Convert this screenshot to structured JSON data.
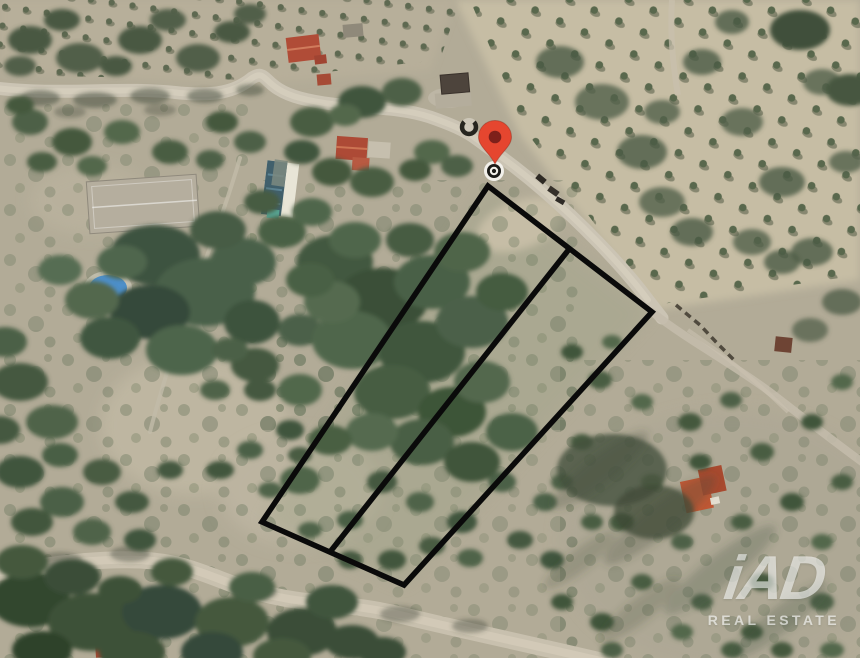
{
  "map": {
    "description": "Aerial satellite view of hillside scrubland with roads, houses, olive groves and an outlined land parcel",
    "colors": {
      "parcel_stroke": "#0a0a0a",
      "pin_red": "#e5462f",
      "pin_core": "#7e201a",
      "pool_blue": "#4d8fc9"
    },
    "parcel": {
      "outline_points": "488,186 652,312 404,585 262,522",
      "divider_points": "570,248 330,552",
      "stroke_width": "5.5"
    }
  },
  "watermark": {
    "brand": "iAD",
    "tagline": "REAL ESTATE"
  }
}
